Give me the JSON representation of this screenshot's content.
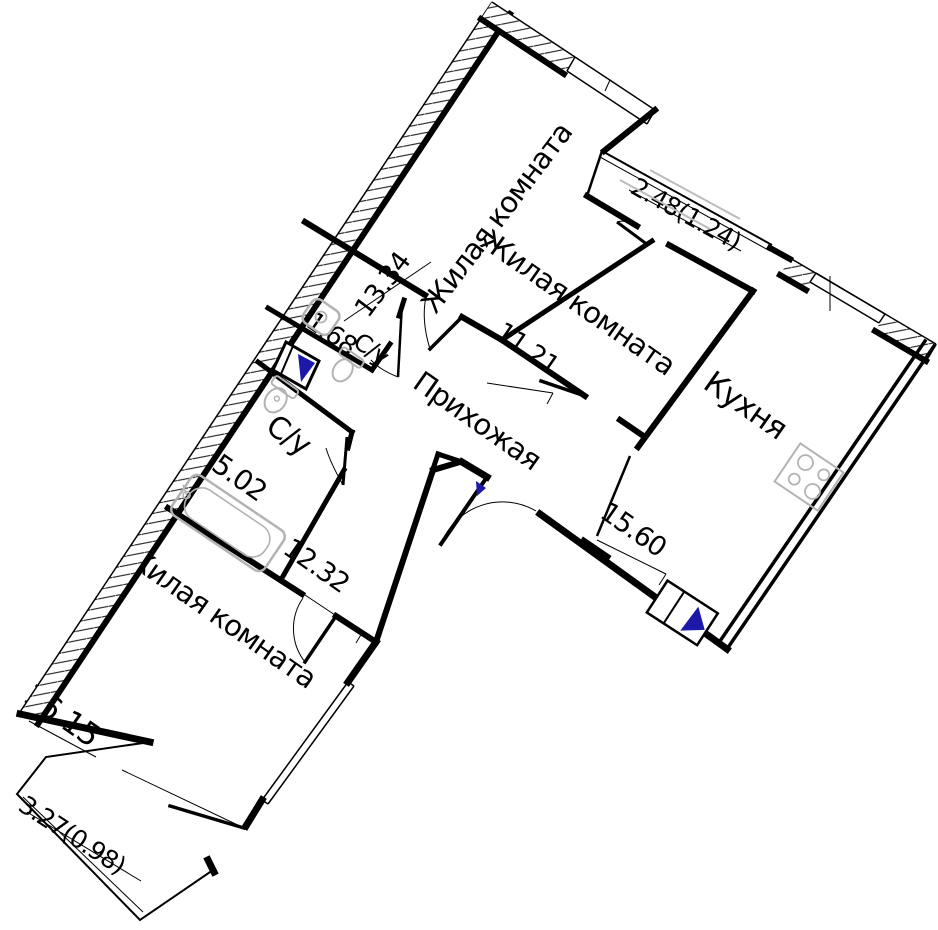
{
  "plan_title": "apartment-floor-plan",
  "rooms": {
    "living1": {
      "name": "Жилая комната",
      "area": "13.34"
    },
    "living2": {
      "name": "Жилая комната",
      "area": "11.21"
    },
    "living3": {
      "name": "Жилая комната",
      "area": "16.15"
    },
    "kitchen": {
      "name": "Кухня",
      "area": "15.60"
    },
    "hallway": {
      "name": "Прихожая",
      "area": "12.32"
    },
    "bath_small": {
      "name": "С/у",
      "area": "1.68"
    },
    "bath_large": {
      "name": "С/у",
      "area": "5.02"
    },
    "loggia": {
      "area": "2.48(1.24)"
    },
    "balcony": {
      "area": "3.27(0.98)"
    }
  },
  "colors": {
    "line": "#000000",
    "fixture": "#b3b3b3",
    "vent_accent": "#1c18a8"
  },
  "icons": [
    "bathtub-icon",
    "toilet-icon",
    "washing-machine-icon",
    "stove-icon",
    "vent-shaft-icon",
    "door-swing-icon",
    "window-icon"
  ]
}
